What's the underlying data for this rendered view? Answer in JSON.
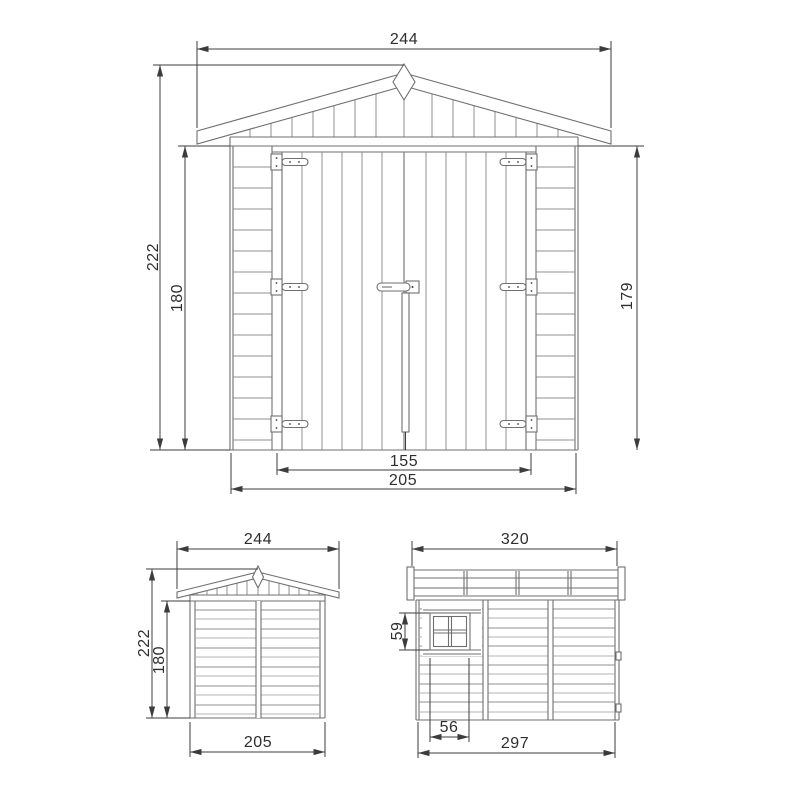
{
  "drawing": {
    "front": {
      "roof_width": "244",
      "total_height": "222",
      "wall_height_left": "180",
      "wall_height_right": "179",
      "door_width": "155",
      "body_width": "205"
    },
    "rear": {
      "roof_width": "244",
      "total_height": "222",
      "wall_height": "180",
      "body_width": "205"
    },
    "side": {
      "roof_depth": "320",
      "window_height": "59",
      "window_width": "56",
      "body_depth": "297"
    }
  }
}
